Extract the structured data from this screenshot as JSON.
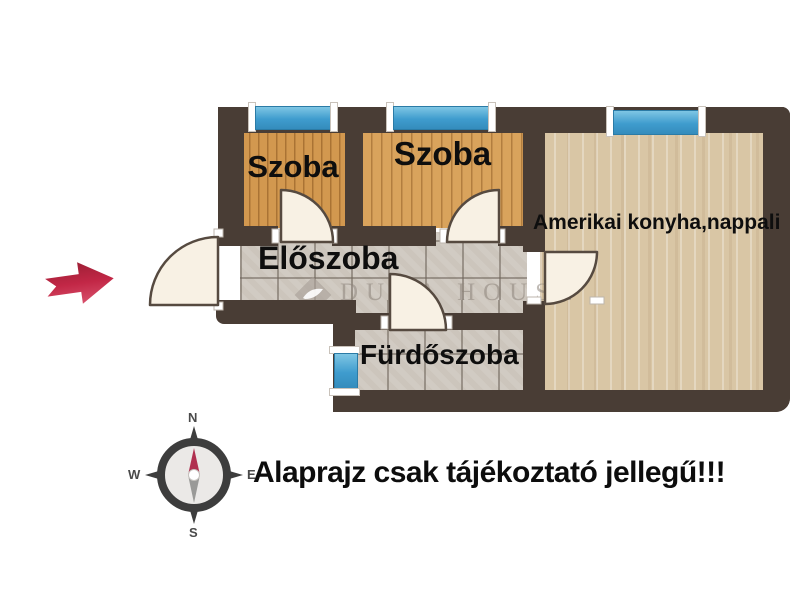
{
  "plan": {
    "rooms": {
      "szoba1": {
        "label": "Szoba"
      },
      "szoba2": {
        "label": "Szoba"
      },
      "eloszoba": {
        "label": "Előszoba"
      },
      "living": {
        "label": "Amerikai konyha,nappali"
      },
      "bathroom": {
        "label": "Fürdőszoba"
      }
    }
  },
  "watermark": {
    "text": "DUNA HOUSE"
  },
  "disclaimer": {
    "text": "Alaprajz csak tájékoztató jellegű!!!"
  },
  "compass": {
    "north": "N",
    "east": "E",
    "south": "S",
    "west": "W"
  },
  "colors": {
    "wall": "#493d35",
    "wood_room": "#d2984f",
    "wood_living": "#d9c6a5",
    "tile": "#ccc5bc",
    "window_blue": "#3f9cce",
    "door_leaf": "#f8f1e4",
    "entrance_arrow": "#c22746"
  }
}
